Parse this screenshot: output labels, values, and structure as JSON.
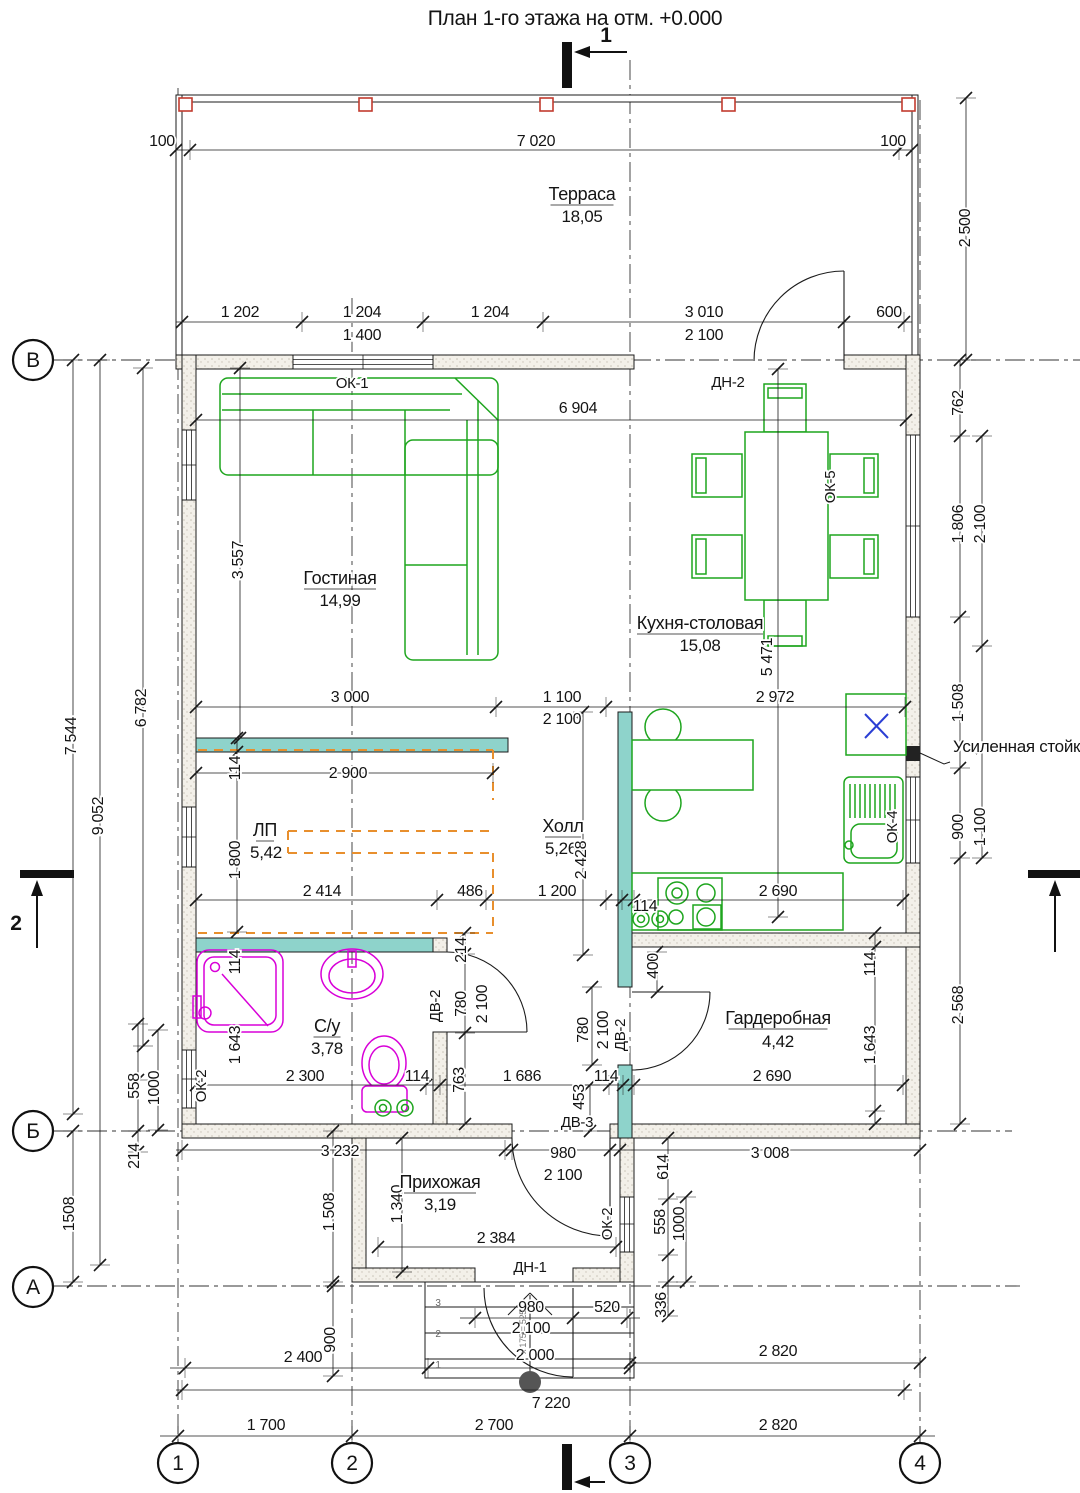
{
  "title": "План 1-го этажа на отм. +0.000",
  "colors": {
    "teal": "#8ed3cb",
    "green": "#1ea51e",
    "magenta": "#d800d8",
    "orange": "#e88f2d",
    "red": "#c23b2e",
    "blue": "#2b3fd4"
  },
  "rooms": [
    {
      "name": "Терраса",
      "area": "18,05"
    },
    {
      "name": "Гостиная",
      "area": "14,99"
    },
    {
      "name": "Кухня-столовая",
      "area": "15,08"
    },
    {
      "name": "ЛП",
      "area": "5,42"
    },
    {
      "name": "Холл",
      "area": "5,26"
    },
    {
      "name": "С/у",
      "area": "3,78"
    },
    {
      "name": "Гардеробная",
      "area": "4,42"
    },
    {
      "name": "Прихожая",
      "area": "3,19"
    }
  ],
  "openings": {
    "windows": [
      "ОК-1",
      "ОК-2",
      "ОК-4",
      "ОК-5"
    ],
    "doors": [
      "ДН-1",
      "ДН-2",
      "ДВ-2",
      "ДВ-3"
    ]
  },
  "axes": {
    "left": [
      {
        "t": "В",
        "x": 33,
        "y": 360
      },
      {
        "t": "Б",
        "x": 33,
        "y": 1131
      },
      {
        "t": "А",
        "x": 33,
        "y": 1287
      }
    ],
    "bottom": [
      {
        "t": "1",
        "x": 178,
        "y": 1463
      },
      {
        "t": "2",
        "x": 352,
        "y": 1463
      },
      {
        "t": "3",
        "x": 630,
        "y": 1463
      },
      {
        "t": "4",
        "x": 920,
        "y": 1463
      }
    ]
  },
  "labels": [
    {
      "id": "drawing-title",
      "t": "План 1-го этажа на отм. +0.000",
      "x": 575,
      "y": 25,
      "k": "title"
    },
    {
      "id": "section-mark-1-label",
      "t": "1",
      "x": 606,
      "y": 42,
      "k": "section"
    },
    {
      "id": "section-mark-2-label",
      "t": "2",
      "x": 16,
      "y": 930,
      "k": "section"
    },
    {
      "t": "100",
      "x": 162,
      "y": 146
    },
    {
      "t": "7 020",
      "x": 536,
      "y": 146
    },
    {
      "t": "100",
      "x": 893,
      "y": 146
    },
    {
      "id": "room-terrace",
      "t": "Терраса",
      "x": 582,
      "y": 200,
      "k": "room",
      "ul": 1
    },
    {
      "id": "room-terrace-area",
      "t": "18,05",
      "x": 582,
      "y": 222,
      "k": "area"
    },
    {
      "t": "2 500",
      "x": 970,
      "y": 228,
      "r": 1
    },
    {
      "t": "1 202",
      "x": 240,
      "y": 317
    },
    {
      "t": "1 204",
      "x": 362,
      "y": 317
    },
    {
      "t": "1 204",
      "x": 490,
      "y": 317
    },
    {
      "t": "3 010",
      "x": 704,
      "y": 317
    },
    {
      "t": "600",
      "x": 889,
      "y": 317
    },
    {
      "t": "1 400",
      "x": 362,
      "y": 340
    },
    {
      "t": "2 100",
      "x": 704,
      "y": 340
    },
    {
      "id": "window-tag-ok1",
      "t": "ОК-1",
      "x": 352,
      "y": 388,
      "k": "tag"
    },
    {
      "id": "door-tag-dn2",
      "t": "ДН-2",
      "x": 728,
      "y": 387,
      "k": "tag"
    },
    {
      "t": "6 904",
      "x": 578,
      "y": 413
    },
    {
      "t": "762",
      "x": 963,
      "y": 403,
      "r": 1
    },
    {
      "t": "1 806",
      "x": 963,
      "y": 524,
      "r": 1
    },
    {
      "t": "2 100",
      "x": 985,
      "y": 524,
      "r": 1
    },
    {
      "id": "window-tag-ok5",
      "t": "ОК-5",
      "x": 835,
      "y": 487,
      "r": 1,
      "k": "tag"
    },
    {
      "t": "3 557",
      "x": 243,
      "y": 560,
      "r": 1
    },
    {
      "id": "room-living",
      "t": "Гостиная",
      "x": 340,
      "y": 584,
      "k": "room",
      "ul": 1
    },
    {
      "id": "room-living-area",
      "t": "14,99",
      "x": 340,
      "y": 606,
      "k": "area"
    },
    {
      "id": "room-kitchen",
      "t": "Кухня-столовая",
      "x": 700,
      "y": 629,
      "k": "room",
      "ul": 1
    },
    {
      "id": "room-kitchen-area",
      "t": "15,08",
      "x": 700,
      "y": 651,
      "k": "area"
    },
    {
      "t": "5 471",
      "x": 772,
      "y": 657,
      "r": 1
    },
    {
      "t": "1 508",
      "x": 963,
      "y": 703,
      "r": 1
    },
    {
      "id": "note-reinforced-post",
      "t": "Усиленная стойка",
      "x": 953,
      "y": 752,
      "k": "note",
      "a": "start"
    },
    {
      "t": "3 000",
      "x": 350,
      "y": 702
    },
    {
      "t": "1 100",
      "x": 562,
      "y": 702
    },
    {
      "t": "2 100",
      "x": 562,
      "y": 724
    },
    {
      "t": "2 972",
      "x": 775,
      "y": 702
    },
    {
      "t": "6 782",
      "x": 146,
      "y": 708,
      "r": 1
    },
    {
      "t": "7 544",
      "x": 76,
      "y": 736,
      "r": 1
    },
    {
      "t": "9 052",
      "x": 103,
      "y": 816,
      "r": 1
    },
    {
      "t": "114",
      "x": 240,
      "y": 768,
      "r": 1
    },
    {
      "t": "2 900",
      "x": 348,
      "y": 778
    },
    {
      "id": "room-lp",
      "t": "ЛП",
      "x": 265,
      "y": 836,
      "k": "room",
      "ul": 1
    },
    {
      "id": "room-lp-area",
      "t": "5,42",
      "x": 266,
      "y": 858,
      "k": "area"
    },
    {
      "t": "1 800",
      "x": 240,
      "y": 860,
      "r": 1
    },
    {
      "id": "room-hall",
      "t": "Холл",
      "x": 563,
      "y": 832,
      "k": "room",
      "ul": 1
    },
    {
      "id": "room-hall-area",
      "t": "5,26",
      "x": 561,
      "y": 854,
      "k": "area"
    },
    {
      "t": "2 428",
      "x": 586,
      "y": 860,
      "r": 1
    },
    {
      "t": "2 414",
      "x": 322,
      "y": 896
    },
    {
      "t": "486",
      "x": 470,
      "y": 896
    },
    {
      "t": "1 200",
      "x": 557,
      "y": 896
    },
    {
      "t": "114",
      "x": 645,
      "y": 911
    },
    {
      "t": "2 690",
      "x": 778,
      "y": 896
    },
    {
      "t": "900",
      "x": 963,
      "y": 827,
      "r": 1
    },
    {
      "t": "1 100",
      "x": 985,
      "y": 827,
      "r": 1
    },
    {
      "id": "window-tag-ok4",
      "t": "ОК-4",
      "x": 897,
      "y": 827,
      "r": 1,
      "k": "tag"
    },
    {
      "t": "114",
      "x": 240,
      "y": 962,
      "r": 1
    },
    {
      "t": "1 643",
      "x": 240,
      "y": 1045,
      "r": 1
    },
    {
      "id": "room-wc",
      "t": "С/у",
      "x": 327,
      "y": 1032,
      "k": "room",
      "ul": 1
    },
    {
      "id": "room-wc-area",
      "t": "3,78",
      "x": 327,
      "y": 1054,
      "k": "area"
    },
    {
      "t": "2 300",
      "x": 305,
      "y": 1081
    },
    {
      "t": "114",
      "x": 417,
      "y": 1081
    },
    {
      "id": "window-tag-ok2-left",
      "t": "ОК-2",
      "x": 206,
      "y": 1086,
      "r": 1,
      "k": "tag"
    },
    {
      "id": "door-tag-dv2-wc",
      "t": "ДВ-2",
      "x": 440,
      "y": 1006,
      "r": 1,
      "k": "tag"
    },
    {
      "t": "780",
      "x": 466,
      "y": 1004,
      "r": 1
    },
    {
      "t": "2 100",
      "x": 487,
      "y": 1004,
      "r": 1
    },
    {
      "t": "214",
      "x": 466,
      "y": 950,
      "r": 1
    },
    {
      "t": "763",
      "x": 464,
      "y": 1080,
      "r": 1
    },
    {
      "t": "1 686",
      "x": 522,
      "y": 1081
    },
    {
      "t": "453",
      "x": 584,
      "y": 1097,
      "r": 1
    },
    {
      "t": "114",
      "x": 606,
      "y": 1081
    },
    {
      "t": "780",
      "x": 588,
      "y": 1030,
      "r": 1
    },
    {
      "t": "2 100",
      "x": 608,
      "y": 1030,
      "r": 1
    },
    {
      "id": "door-tag-dv2-ward",
      "t": "ДВ-2",
      "x": 625,
      "y": 1035,
      "r": 1,
      "k": "tag"
    },
    {
      "t": "400",
      "x": 658,
      "y": 966,
      "r": 1
    },
    {
      "id": "room-ward",
      "t": "Гардеробная",
      "x": 778,
      "y": 1024,
      "k": "room",
      "ul": 1
    },
    {
      "id": "room-ward-area",
      "t": "4,42",
      "x": 778,
      "y": 1047,
      "k": "area"
    },
    {
      "t": "114",
      "x": 875,
      "y": 964,
      "r": 1
    },
    {
      "t": "1 643",
      "x": 875,
      "y": 1045,
      "r": 1
    },
    {
      "t": "2 690",
      "x": 772,
      "y": 1081
    },
    {
      "t": "2 568",
      "x": 963,
      "y": 1005,
      "r": 1
    },
    {
      "id": "door-tag-dv3",
      "t": "ДВ-3",
      "x": 577,
      "y": 1127,
      "k": "tag"
    },
    {
      "t": "980",
      "x": 563,
      "y": 1158
    },
    {
      "t": "2 100",
      "x": 563,
      "y": 1180
    },
    {
      "t": "3 232",
      "x": 340,
      "y": 1156
    },
    {
      "t": "3 008",
      "x": 770,
      "y": 1158
    },
    {
      "t": "614",
      "x": 668,
      "y": 1167,
      "r": 1
    },
    {
      "t": "558",
      "x": 665,
      "y": 1222,
      "r": 1
    },
    {
      "t": "1000",
      "x": 684,
      "y": 1224,
      "r": 1
    },
    {
      "id": "window-tag-ok2-right",
      "t": "ОК-2",
      "x": 612,
      "y": 1224,
      "r": 1,
      "k": "tag"
    },
    {
      "t": "558",
      "x": 139,
      "y": 1086,
      "r": 1
    },
    {
      "t": "1000",
      "x": 159,
      "y": 1088,
      "r": 1
    },
    {
      "t": "214",
      "x": 139,
      "y": 1156,
      "r": 1
    },
    {
      "t": "1508",
      "x": 74,
      "y": 1214,
      "r": 1
    },
    {
      "t": "1 508",
      "x": 334,
      "y": 1212,
      "r": 1
    },
    {
      "t": "1 340",
      "x": 402,
      "y": 1204,
      "r": 1
    },
    {
      "id": "room-entry",
      "t": "Прихожая",
      "x": 440,
      "y": 1188,
      "k": "room",
      "ul": 1
    },
    {
      "id": "room-entry-area",
      "t": "3,19",
      "x": 440,
      "y": 1210,
      "k": "area"
    },
    {
      "t": "2 384",
      "x": 496,
      "y": 1243
    },
    {
      "id": "door-tag-dn1",
      "t": "ДН-1",
      "x": 530,
      "y": 1272,
      "k": "tag"
    },
    {
      "t": "980",
      "x": 531,
      "y": 1312
    },
    {
      "t": "2 100",
      "x": 531,
      "y": 1333
    },
    {
      "t": "520",
      "x": 607,
      "y": 1312
    },
    {
      "t": "336",
      "x": 666,
      "y": 1305,
      "r": 1
    },
    {
      "t": "900",
      "x": 335,
      "y": 1340,
      "r": 1
    },
    {
      "t": "2 400",
      "x": 303,
      "y": 1362
    },
    {
      "t": "2 000",
      "x": 535,
      "y": 1360
    },
    {
      "t": "7 220",
      "x": 551,
      "y": 1408
    },
    {
      "t": "1 700",
      "x": 266,
      "y": 1430
    },
    {
      "t": "2 700",
      "x": 494,
      "y": 1430
    },
    {
      "t": "2 820",
      "x": 778,
      "y": 1356
    },
    {
      "t": "2 820",
      "x": 778,
      "y": 1430
    },
    {
      "id": "stair-rise-note",
      "t": "х 175 = 525",
      "x": 526,
      "y": 1332,
      "r": 1,
      "k": "tiny"
    },
    {
      "id": "step-number-3",
      "t": "3",
      "x": 438,
      "y": 1306,
      "k": "step"
    },
    {
      "id": "step-number-2",
      "t": "2",
      "x": 438,
      "y": 1337,
      "k": "step"
    },
    {
      "id": "step-number-1",
      "t": "1",
      "x": 438,
      "y": 1368,
      "k": "step"
    }
  ]
}
